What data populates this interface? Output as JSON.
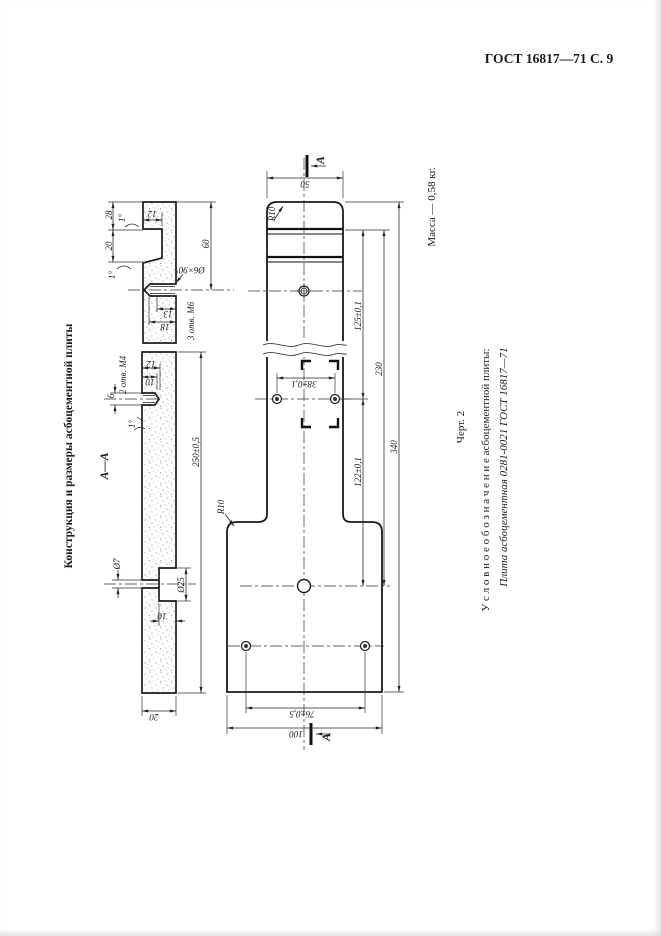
{
  "header": {
    "text": "ГОСТ 16817—71 С. 9"
  },
  "titles": {
    "left_title": "Конструкция и размеры асбоцементной плиты",
    "mass": "Масса — 0,58 кг.",
    "figure": "Черт. 2",
    "designation_intro": "У с л о в н о е   о б о з н а ч е н и е   асбоцементной плиты:",
    "designation": "Плита асбоцементная 0281-0021 ГОСТ 16817—71",
    "section": "А—А",
    "cut_mark": "А"
  },
  "dims": {
    "w50": "50",
    "l340": "340",
    "l230": "230",
    "l125": "125±0,1",
    "l122": "122±0,1",
    "w38": "38±0,1",
    "w76": "76±0,5",
    "w100": "100",
    "r10": "R10",
    "h60": "60",
    "l250": "250±0,5",
    "s28": "28",
    "s20": "20",
    "s12": "12",
    "angle1": "1°",
    "chamfer": "Ø6×90°",
    "t13": "13",
    "t18": "18",
    "m6_holes": "3 отв. М6",
    "m4_holes": "2 отв. М4",
    "t12": "12",
    "t10": "10",
    "d6": "6",
    "d7": "Ø7",
    "d25": "Ø25",
    "cb10": "10",
    "th20": "20"
  }
}
